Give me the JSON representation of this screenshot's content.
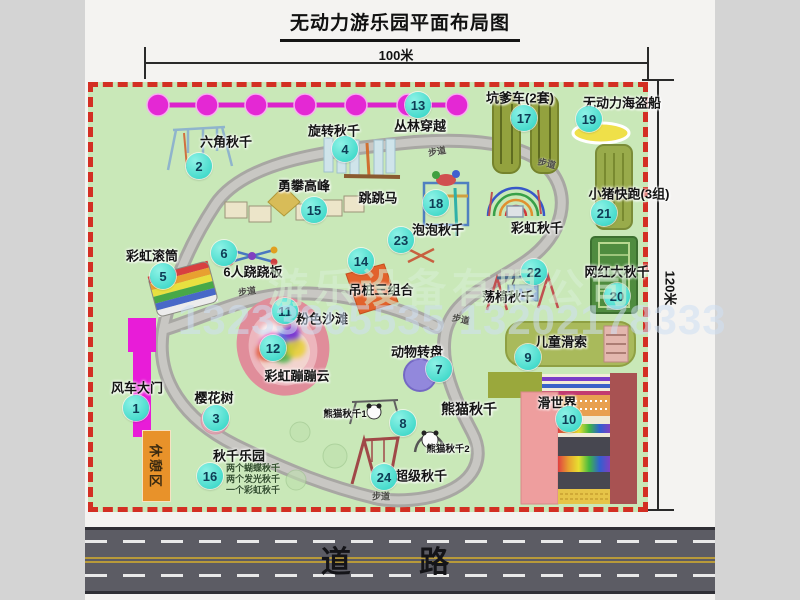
{
  "title": "无动力游乐园平面布局图",
  "dimensions": {
    "width": "100米",
    "height": "120米"
  },
  "road_label": "道 路",
  "walkway_label": "步道",
  "rest_area_label": "休憩区",
  "watermark": {
    "company": "游乐设备有限公司",
    "phones": "13233805535 13202178333"
  },
  "features": {
    "windmill_gate": {
      "num": "1",
      "label": "风车大门"
    },
    "hex_swing": {
      "num": "2",
      "label": "六角秋千"
    },
    "cherry_tree": {
      "num": "3",
      "label": "樱花树"
    },
    "rotary_swing": {
      "num": "4",
      "label": "旋转秋千"
    },
    "rainbow_roller": {
      "num": "5",
      "label": "彩虹滚筒"
    },
    "seesaw6": {
      "num": "6",
      "label": "6人跷跷板"
    },
    "animal_turntable": {
      "num": "7",
      "label": "动物转盘"
    },
    "panda_swing": {
      "num": "8",
      "label": "熊猫秋千",
      "sub1": "熊猫秋千1",
      "sub2": "熊猫秋千2"
    },
    "kids_zipline": {
      "num": "9",
      "label": "儿童滑索"
    },
    "slide_world": {
      "num": "10",
      "label": "滑世界"
    },
    "pink_beach": {
      "num": "11",
      "label": "粉色沙滩"
    },
    "rainbow_cloud": {
      "num": "12",
      "label": "彩虹蹦蹦云"
    },
    "jungle_crossing": {
      "num": "13",
      "label": "丛林穿越"
    },
    "hanging_piles": {
      "num": "14",
      "label": "吊桩三组合"
    },
    "climb_peak": {
      "num": "15",
      "label": "勇攀高峰"
    },
    "swing_park": {
      "num": "16",
      "label": "秋千乐园",
      "details": [
        "两个蝴蝶秋千",
        "两个发光秋千",
        "一个彩虹秋千"
      ]
    },
    "pit_cart": {
      "num": "17",
      "label": "坑爹车(2套)"
    },
    "jump_horse": {
      "num": "18",
      "label": "跳跳马"
    },
    "pirate_ship": {
      "num": "19",
      "label": "无动力海盗船"
    },
    "big_swing": {
      "num": "20",
      "label": "网红大秋千"
    },
    "piggy_run": {
      "num": "21",
      "label": "小猪快跑(3组)"
    },
    "chair_swing": {
      "num": "22",
      "label": "荡椅秋千"
    },
    "bubble_swing": {
      "num": "23",
      "label": "泡泡秋千"
    },
    "super_swing": {
      "num": "24",
      "label": "超级秋千"
    },
    "rainbow_swing": {
      "label": "彩虹秋千"
    }
  }
}
